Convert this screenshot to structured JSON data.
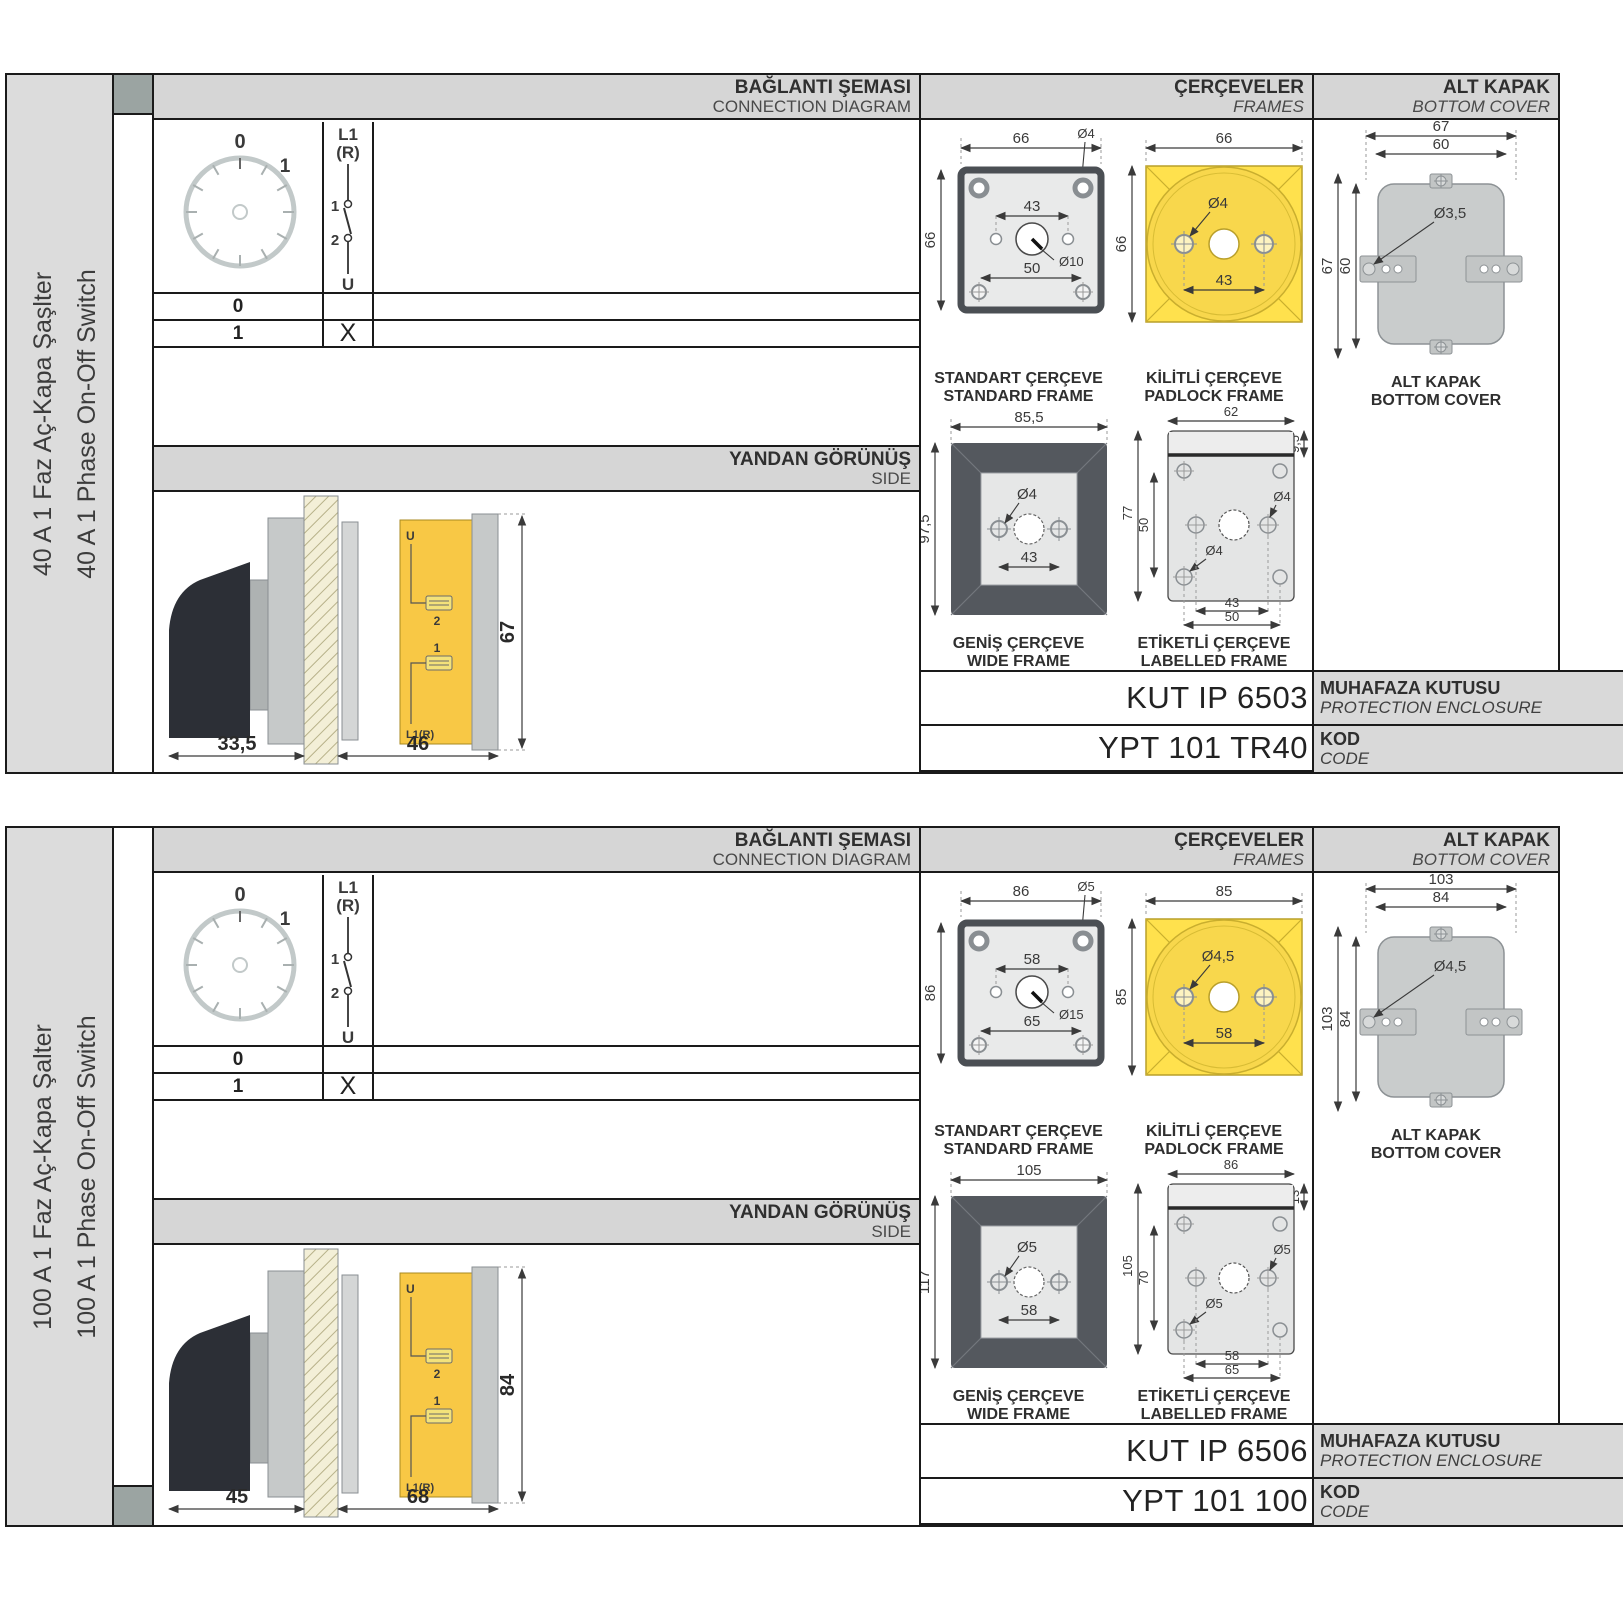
{
  "common": {
    "connection_title": "BAĞLANTI ŞEMASI",
    "connection_subtitle": "CONNECTION DIAGRAM",
    "frames_title": "ÇERÇEVELER",
    "frames_subtitle": "FRAMES",
    "cover_title": "ALT KAPAK",
    "cover_subtitle": "BOTTOM COVER",
    "side_title": "YANDAN GÖRÜNÜŞ",
    "side_subtitle": "SIDE",
    "standard_frame_tr": "STANDART ÇERÇEVE",
    "standard_frame_en": "STANDARD FRAME",
    "padlock_frame_tr": "KİLİTLİ ÇERÇEVE",
    "padlock_frame_en": "PADLOCK FRAME",
    "wide_frame_tr": "GENİŞ ÇERÇEVE",
    "wide_frame_en": "WIDE FRAME",
    "labelled_frame_tr": "ETİKETLİ ÇERÇEVE",
    "labelled_frame_en": "LABELLED FRAME",
    "cover_caption_tr": "ALT KAPAK",
    "cover_caption_en": "BOTTOM COVER",
    "enclosure_label_tr": "MUHAFAZA KUTUSU",
    "enclosure_label_en": "PROTECTION ENCLOSURE",
    "code_label_tr": "KOD",
    "code_label_en": "CODE",
    "dial": {
      "pos0": "0",
      "pos1": "1"
    },
    "switch": {
      "line": "L1",
      "line2": "(R)",
      "term1": "1",
      "term2": "2",
      "out": "U"
    },
    "table": {
      "row0": "0",
      "row1": "1",
      "mark": "X"
    },
    "side_terminals": {
      "u": "U",
      "t2": "2",
      "t1": "1",
      "l1r": "L1(R)"
    },
    "colors": {
      "accent_yellow": "#ffe14d",
      "body_yellow": "#f8c845",
      "frame_dark": "#54585e",
      "square_teal": "#9ba4a2"
    }
  },
  "panels": [
    {
      "name_tr": "40 A 1 Faz Aç-Kapa Şaşlter",
      "name_en": "40 A 1 Phase On-Off Switch",
      "enclosure_code": "KUT IP 6503",
      "code": "YPT 101 TR40",
      "standard_frame": {
        "width": "66",
        "height": "66",
        "hole_d": "Ø4",
        "spacing_top": "43",
        "center_d": "Ø10",
        "spacing_bottom": "50"
      },
      "padlock_frame": {
        "width": "66",
        "height": "66",
        "hole_d": "Ø4",
        "spacing": "43"
      },
      "wide_frame": {
        "width": "85,5",
        "height": "97,5",
        "hole_d": "Ø4",
        "spacing": "43"
      },
      "labelled_frame": {
        "width": "62",
        "strip": "9,5",
        "height": "77",
        "inner_height": "50",
        "hole_d1": "Ø4",
        "hole_d2": "Ø4",
        "spacing1": "43",
        "spacing2": "50"
      },
      "bottom_cover": {
        "width_outer": "67",
        "width_inner": "60",
        "hole_d": "Ø3,5",
        "height_outer": "67",
        "height_inner": "60"
      },
      "side_view": {
        "handle_depth": "33,5",
        "body_depth": "46",
        "height": "67"
      }
    },
    {
      "name_tr": "100 A 1 Faz Aç-Kapa Şalter",
      "name_en": "100 A 1 Phase On-Off Switch",
      "enclosure_code": "KUT IP 6506",
      "code": "YPT 101 100",
      "standard_frame": {
        "width": "86",
        "height": "86",
        "hole_d": "Ø5",
        "spacing_top": "58",
        "center_d": "Ø15",
        "spacing_bottom": "65"
      },
      "padlock_frame": {
        "width": "85",
        "height": "85",
        "hole_d": "Ø4,5",
        "spacing": "58"
      },
      "wide_frame": {
        "width": "105",
        "height": "117",
        "hole_d": "Ø5",
        "spacing": "58"
      },
      "labelled_frame": {
        "width": "86",
        "strip": "13",
        "height": "105",
        "inner_height": "70",
        "hole_d1": "Ø5",
        "hole_d2": "Ø5",
        "spacing1": "58",
        "spacing2": "65"
      },
      "bottom_cover": {
        "width_outer": "103",
        "width_inner": "84",
        "hole_d": "Ø4,5",
        "height_outer": "103",
        "height_inner": "84"
      },
      "side_view": {
        "handle_depth": "45",
        "body_depth": "68",
        "height": "84"
      }
    }
  ]
}
